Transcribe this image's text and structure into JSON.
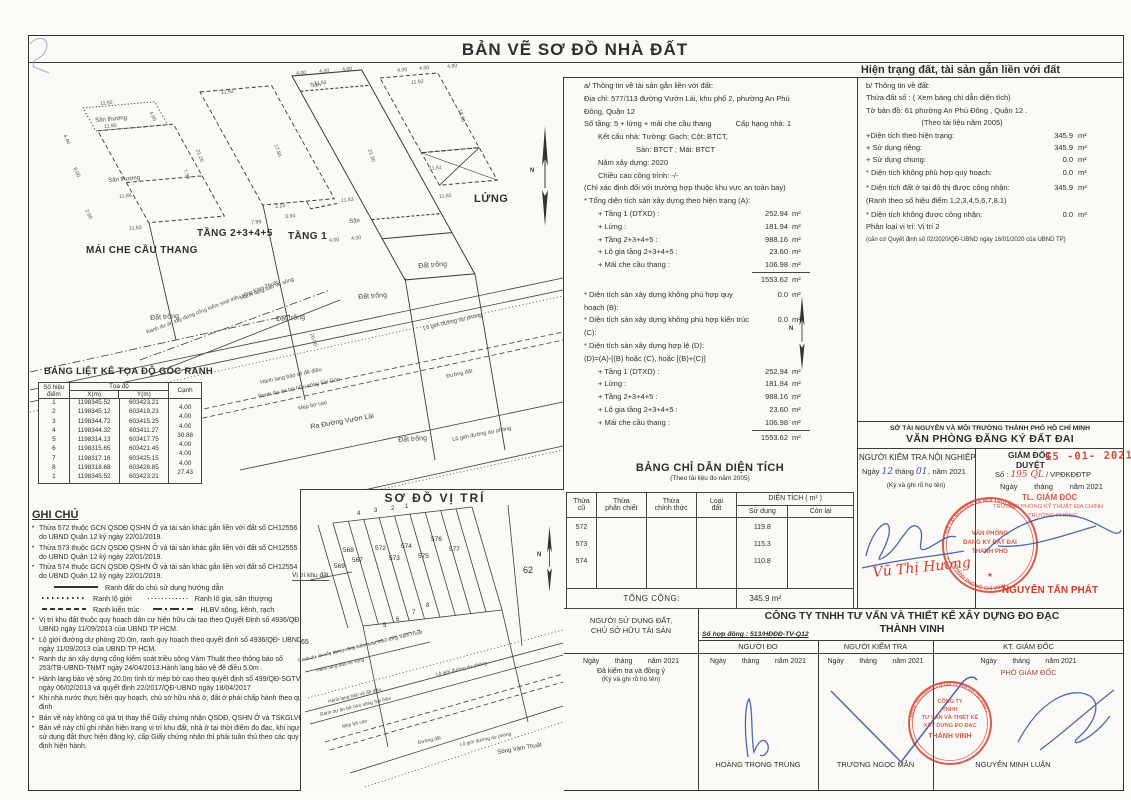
{
  "page": {
    "title": "BẢN VẼ SƠ ĐỒ NHÀ ĐẤT",
    "subtitle": "Hiện trạng đất, tài sản gắn liền với đất"
  },
  "drawing": {
    "san_thuong": "Sân thượng",
    "san": "Sân",
    "dat_trong": "Đất trống",
    "mai_che": "MÁI CHE CẦU THANG",
    "tang2345": "TẦNG 2+3+4+5",
    "tang1": "TẦNG 1",
    "lung": "LỬNG",
    "hlbv_song": "Hành lang bảo vệ sông",
    "hlbv_de_dieu": "Hành lang bảo vệ đê điều",
    "ranh_cong": "Ranh dự án xây dựng cống kiểm soát triều sông Vàm Thuật",
    "ranh_bo_huu": "Ranh dự án bờ hữu sông Sài Gòn",
    "mep_bo_cao": "Mép bờ cao",
    "ra_duong": "Ra Đường Vườn Lài",
    "lo_gioi": "Lộ giới đường dự phòng",
    "duong_dat": "Đường đất",
    "song_vam_thuat": "Sông Vàm Thuật",
    "north": "N",
    "dims": [
      "11.92",
      "4.00",
      "11.90",
      "8.00",
      "11.86",
      "7.90",
      "11.83",
      "4.40",
      "2.00",
      "11.92",
      "21.26",
      "17.86",
      "7.99",
      "3.94",
      "2.24",
      "4.00",
      "4.00",
      "4.00",
      "11.92",
      "21.30",
      "11.83",
      "4.00",
      "4.00",
      "4.00",
      "4.00",
      "4.80",
      "11.92",
      "13.20",
      "11.61",
      "11.82",
      "20.00"
    ]
  },
  "coord_table": {
    "title": "BẢNG LIỆT KÊ TỌA ĐỘ GÓC RANH",
    "col_point1": "Số hiệu",
    "col_point2": "điểm",
    "col_coord": "Tọa độ",
    "col_x": "X(m)",
    "col_y": "Y(m)",
    "col_edge": "Cạnh",
    "rows": [
      {
        "p": "1",
        "x": "1198345.52",
        "y": "603423.21"
      },
      {
        "p": "2",
        "x": "1198345.12",
        "y": "603419.23"
      },
      {
        "p": "3",
        "x": "1198344.72",
        "y": "603415.25"
      },
      {
        "p": "4",
        "x": "1198344.32",
        "y": "603411.27"
      },
      {
        "p": "5",
        "x": "1198314.13",
        "y": "603417.75"
      },
      {
        "p": "6",
        "x": "1198315.65",
        "y": "603421.45"
      },
      {
        "p": "7",
        "x": "1198317.16",
        "y": "603425.15"
      },
      {
        "p": "8",
        "x": "1198318.68",
        "y": "603428.85"
      },
      {
        "p": "1",
        "x": "1198345.52",
        "y": "603423.21"
      }
    ],
    "edges": [
      "4.00",
      "4.00",
      "4.00",
      "30.88",
      "4.00",
      "4.00",
      "4.00",
      "27.43"
    ]
  },
  "notes": {
    "title": "GHI CHÚ",
    "bullets_top": [
      "Thửa 572 thuộc GCN QSDĐ QSHN Ở và tài sản khác gắn liền với đất số CH12556 do UBND Quận 12 ký ngày 22/01/2019.",
      "Thửa 573 thuộc GCN QSDĐ QSHN Ở và tài sản khác gắn liền với đất số CH12555 do UBND Quận 12 ký ngày 22/01/2019.",
      "Thửa 574 thuộc GCN QSDĐ QSHN Ở và tài sản khác gắn liền với đất số CH12554 do UBND Quận 12 ký ngày 22/01/2019."
    ],
    "legend": {
      "l1": "Ranh  đất do chủ sử dụng hướng dẫn",
      "l2a": "Ranh lộ giới",
      "l2b": "Ranh lô gia, sân thượng",
      "l3a": "Ranh kiến trúc",
      "l3b": "HLBV sông, kênh, rạch"
    },
    "bullets_bottom": [
      "Vị trí khu đất thuộc quy hoạch dân cư hiện hữu cải tạo theo Quyết Định số 4936/QĐ- UBND ngày 11/09/2013 của UBND TP HCM.",
      "Lộ giới đường dự phòng 20.0m, ranh quy hoạch theo quyết định số 4936/QĐ- UBND ngày 11/09/2013 của UBND TP HCM.",
      "Ranh dự án xây dựng cống kiểm soát triều sông Vàm Thuật theo thông báo số 253/TB-UBND-TNMT ngày 24/04/2013.Hành lang bảo vệ đê điều 5.0m .",
      "Hành lang bảo vệ sông 20.0m tính từ mép bờ cao theo quyết định số 499/QĐ-SGTVT ngày 06/02/2013 và quyết định 22/2017/QĐ-UBND ngày 18/04/2017",
      "Khi nhà nước thực hiện quy hoạch, chủ sở hữu nhà ở, đất ở phải chấp hành theo quy định",
      "Bản vẽ này không có giá trị thay thế Giấy chứng nhận QSDĐ, QSHN Ở và TSKGLVĐ;",
      "Bản vẽ này chỉ ghi nhận hiện trạng vị trí khu đất, nhà ở tại thời điểm đo đạc, khi người sử dụng đất thực hiện đăng ký, cấp Giấy chứng nhận thì phải tuân thủ theo các quy định hiện hành."
    ]
  },
  "map": {
    "title": "SƠ ĐỒ VỊ TRÍ",
    "vi_tri_khu_dat": "Vị trí khu đất",
    "parcels": [
      "569",
      "568",
      "567",
      "572",
      "573",
      "574",
      "575",
      "576",
      "577"
    ],
    "corners_top": [
      "4",
      "3",
      "2",
      "1"
    ],
    "corners_bottom": [
      "5",
      "6",
      "7",
      "8"
    ],
    "n62": "62",
    "n65": "65"
  },
  "section_a": {
    "heading": "a/  Thông tin về tài sản gắn liền với đất:",
    "address": "Địa chỉ: 577/113 đường Vườn Lài,  khu phố 2, phường An Phú Đông, Quận 12",
    "floors": "Số tầng:  5 + lửng + mái che cầu thang",
    "grade": "Cấp hạng nhà: 1",
    "structure": "Kết cấu nhà: Tường: Gạch; Cột: BTCT,",
    "structure2": "Sàn: BTCT ; Mái: BTCT",
    "year": "Năm xây dựng: 2020",
    "height": "Chiều cao công trình: -/-",
    "height_note": "(Chỉ xác định đối với trường hợp thuộc khu vực an toàn bay)",
    "total_a_label": "* Tổng diện tích sàn xây dựng theo hiện trạng (A):",
    "area_rows": [
      {
        "label": "+ Tầng 1 (DTXD) :",
        "value": "252.94",
        "unit": "m²"
      },
      {
        "label": "+ Lửng :",
        "value": "181.94",
        "unit": "m²"
      },
      {
        "label": "+ Tầng 2+3+4+5 :",
        "value": "988.16",
        "unit": "m²"
      },
      {
        "label": "+ Lô gia tầng 2+3+4+5 :",
        "value": "23.60",
        "unit": "m²"
      },
      {
        "label": "+ Mái che cầu thang :",
        "value": "106.98",
        "unit": "m²"
      }
    ],
    "total_value": "1553.62",
    "total_unit": "m²",
    "b_row": {
      "label": "* Diện tích sàn xây dựng không phù hợp quy hoạch (B):",
      "value": "0.0",
      "unit": "m²"
    },
    "c_row": {
      "label": "* Diện tích sàn xây dựng không phù hợp kiến trúc (C):",
      "value": "0.0",
      "unit": "m²"
    },
    "d_head": "* Diện tích sàn xây dựng hợp lệ (D):",
    "d_formula": "(D)=(A)-[(B) hoặc (C), hoặc [(B)+(C)]"
  },
  "section_b": {
    "heading": "b/ Thông tin về đất:",
    "parcel": "Thửa đất số : ( Xem bảng chỉ dẫn diện tích)",
    "sheet": "Tờ bản đồ: 61 phường An Phú Đông , Quận 12 .",
    "doc": "(Theo tài liệu năm 2005)",
    "rows": [
      {
        "label": "+Diện tích theo hiện trạng:",
        "value": "345.9",
        "unit": "m²"
      },
      {
        "label": "+ Sử dụng riêng:",
        "value": "345.9",
        "unit": "m²"
      },
      {
        "label": "+ Sử dụng chung:",
        "value": "0.0",
        "unit": "m²"
      },
      {
        "label": "* Diện tích không phù hợp quy hoạch:",
        "value": "0.0",
        "unit": "m²"
      },
      {
        "label": "* Diện tích đất ở tại đô thị được công nhận:",
        "value": "345.9",
        "unit": "m²"
      }
    ],
    "ranh_note": "(Ranh theo số hiệu điểm 1,2,3,4,5,6,7,8,1)",
    "not_recognized": {
      "label": "* Diện tích không được công nhận:",
      "value": "0.0",
      "unit": "m²"
    },
    "vi_tri": "Phân loại vị trí:    Vị trí 2",
    "vi_tri_note": "(căn cứ Quyết định số 02/2020/QĐ-UBND ngày 16/01/2020 của UBND TP)"
  },
  "area_table": {
    "title": "BẢNG CHỈ DẪN DIỆN TÍCH",
    "subtitle": "(Theo tài liệu đo năm 2005)",
    "col1a": "Thửa",
    "col1b": "cũ",
    "col2a": "Thửa",
    "col2b": "phân chiết",
    "col3a": "Thửa",
    "col3b": "chính thức",
    "col4a": "Loại",
    "col4b": "đất",
    "col5": "DIỆN TÍCH ( m² )",
    "col5a": "Sử dụng",
    "col5b": "Còn lại",
    "parcels": [
      "572",
      "573",
      "574"
    ],
    "used": [
      "119.8",
      "115.3",
      "110.8"
    ],
    "total_label": "TỔNG CỘNG:",
    "total_value": "345.9 m²"
  },
  "registry": {
    "dept": "SỞ TÀI NGUYÊN VÀ MÔI TRƯỜNG THÀNH PHỐ HỒ CHÍ MINH",
    "office": "VĂN PHÒNG ĐĂNG KÝ ĐẤT ĐAI",
    "left": {
      "title": "NGƯỜI KIỂM TRA NỘI NGHIỆP",
      "ngay": "Ngày",
      "d": "12",
      "thang": "tháng",
      "m": "01.",
      "nam": "năm 2021",
      "note": "(Ký và ghi rõ họ tên)",
      "signer": "Vũ Thị Hường"
    },
    "right": {
      "title1": "GIÁM ĐỐC",
      "title2": "DUYỆT",
      "stamp_date": "15 -01- 2021",
      "so": "Số :",
      "so_num": "195 QL",
      "so_suffix": "/ VPĐKĐĐTP",
      "date_line": "Ngày        tháng        năm 2021",
      "tl": "TL. GIÁM ĐỐC",
      "role": "TRƯỞNG PHÒNG KỸ THUẬT ĐỊA CHÍNH",
      "role2": "TRƯỞNG PHÒNG",
      "name": "NGUYỄN TẤN PHÁT"
    },
    "stamp": {
      "line1": "VĂN PHÒNG",
      "line2": "ĐĂNG KÝ ĐẤT ĐAI",
      "line3": "THÀNH PHỐ",
      "ring_top": "SỞ TÀI NGUYÊN VÀ MÔI TRƯỜNG",
      "ring_bottom": "THÀNH PHỐ HỒ CHÍ MINH",
      "star": "★"
    }
  },
  "company": {
    "owner1": "NGƯỜI SỬ DỤNG ĐẤT,",
    "owner2": "CHỦ SỞ HỮU TÀI SẢN",
    "name1": "CÔNG TY TNHH TƯ VẤN VÀ THIẾT KẾ XÂY DỰNG ĐO ĐẠC",
    "name2": "THÀNH VINH",
    "contract": "Số hợp đồng : 513/HĐĐĐ-TV-Q12",
    "col_do": "NGƯỜI ĐO",
    "col_kt": "NGƯỜI KIỂM TRA",
    "col_gd": "KT. GIÁM ĐỐC",
    "date": "Ngày        tháng        năm 2021",
    "approved": "Đã kiểm tra và đồng ý",
    "sign_note": "(Ký và ghi rõ họ tên)",
    "deputy": "PHÓ GIÁM ĐỐC",
    "names": [
      "HOÀNG TRỌNG TRUNG",
      "TRƯƠNG NGỌC MẪN",
      "NGUYỄN MINH LUẬN"
    ],
    "stamp": {
      "l1": "CÔ NG TY",
      "l1x": "CÔNG TY",
      "l2": "TNHH",
      "l3": "TƯ VẤN VÀ THIẾT KẾ",
      "l4": "XÂY DỰNG ĐO ĐẠC",
      "l5": "THÀNH VINH",
      "ring": "• MSDN: 0313793734 • QUẬN 12 - TP. HỒ CHÍ MINH •"
    }
  }
}
